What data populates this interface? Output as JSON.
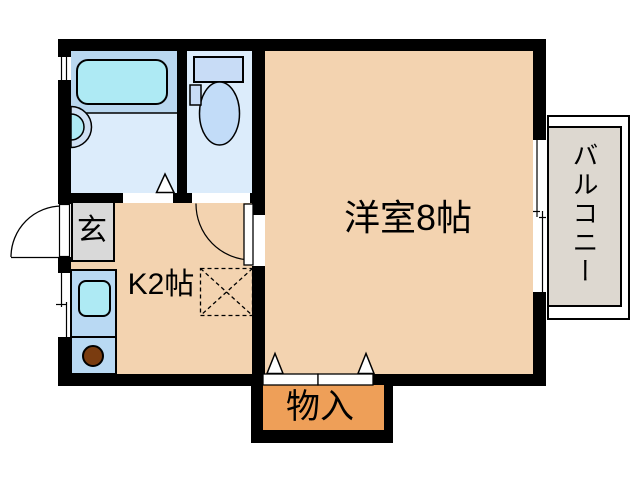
{
  "plan": {
    "rooms": {
      "western_room": {
        "label": "洋室8帖"
      },
      "kitchen": {
        "label": "K2帖"
      },
      "entrance": {
        "label": "玄"
      },
      "storage": {
        "label": "物入"
      },
      "balcony": {
        "label": "バルコニー"
      }
    },
    "fixtures": {
      "bathtub": "bathtub",
      "washbasin": "washbasin",
      "toilet": "toilet",
      "toilet_tank": "toilet-tank",
      "kitchen_sink": "kitchen-sink",
      "stove_burner": "stove-burner",
      "appliance_space": "appliance-space"
    },
    "colors": {
      "wall": "#000000",
      "room": "#f3d3b0",
      "storage": "#ee9f58",
      "entrance": "#d9d9d9",
      "balcony": "#ddd8d0",
      "wet_room": "#dcecfb",
      "bath_zone": "#b9d7ef",
      "bathtub": "#aeeaf4",
      "fixture_blue": "#c8dcf6",
      "bowl_blue": "#c2dcf8",
      "sink_unit": "#b9d9f3",
      "burner": "#7a3c10"
    }
  }
}
